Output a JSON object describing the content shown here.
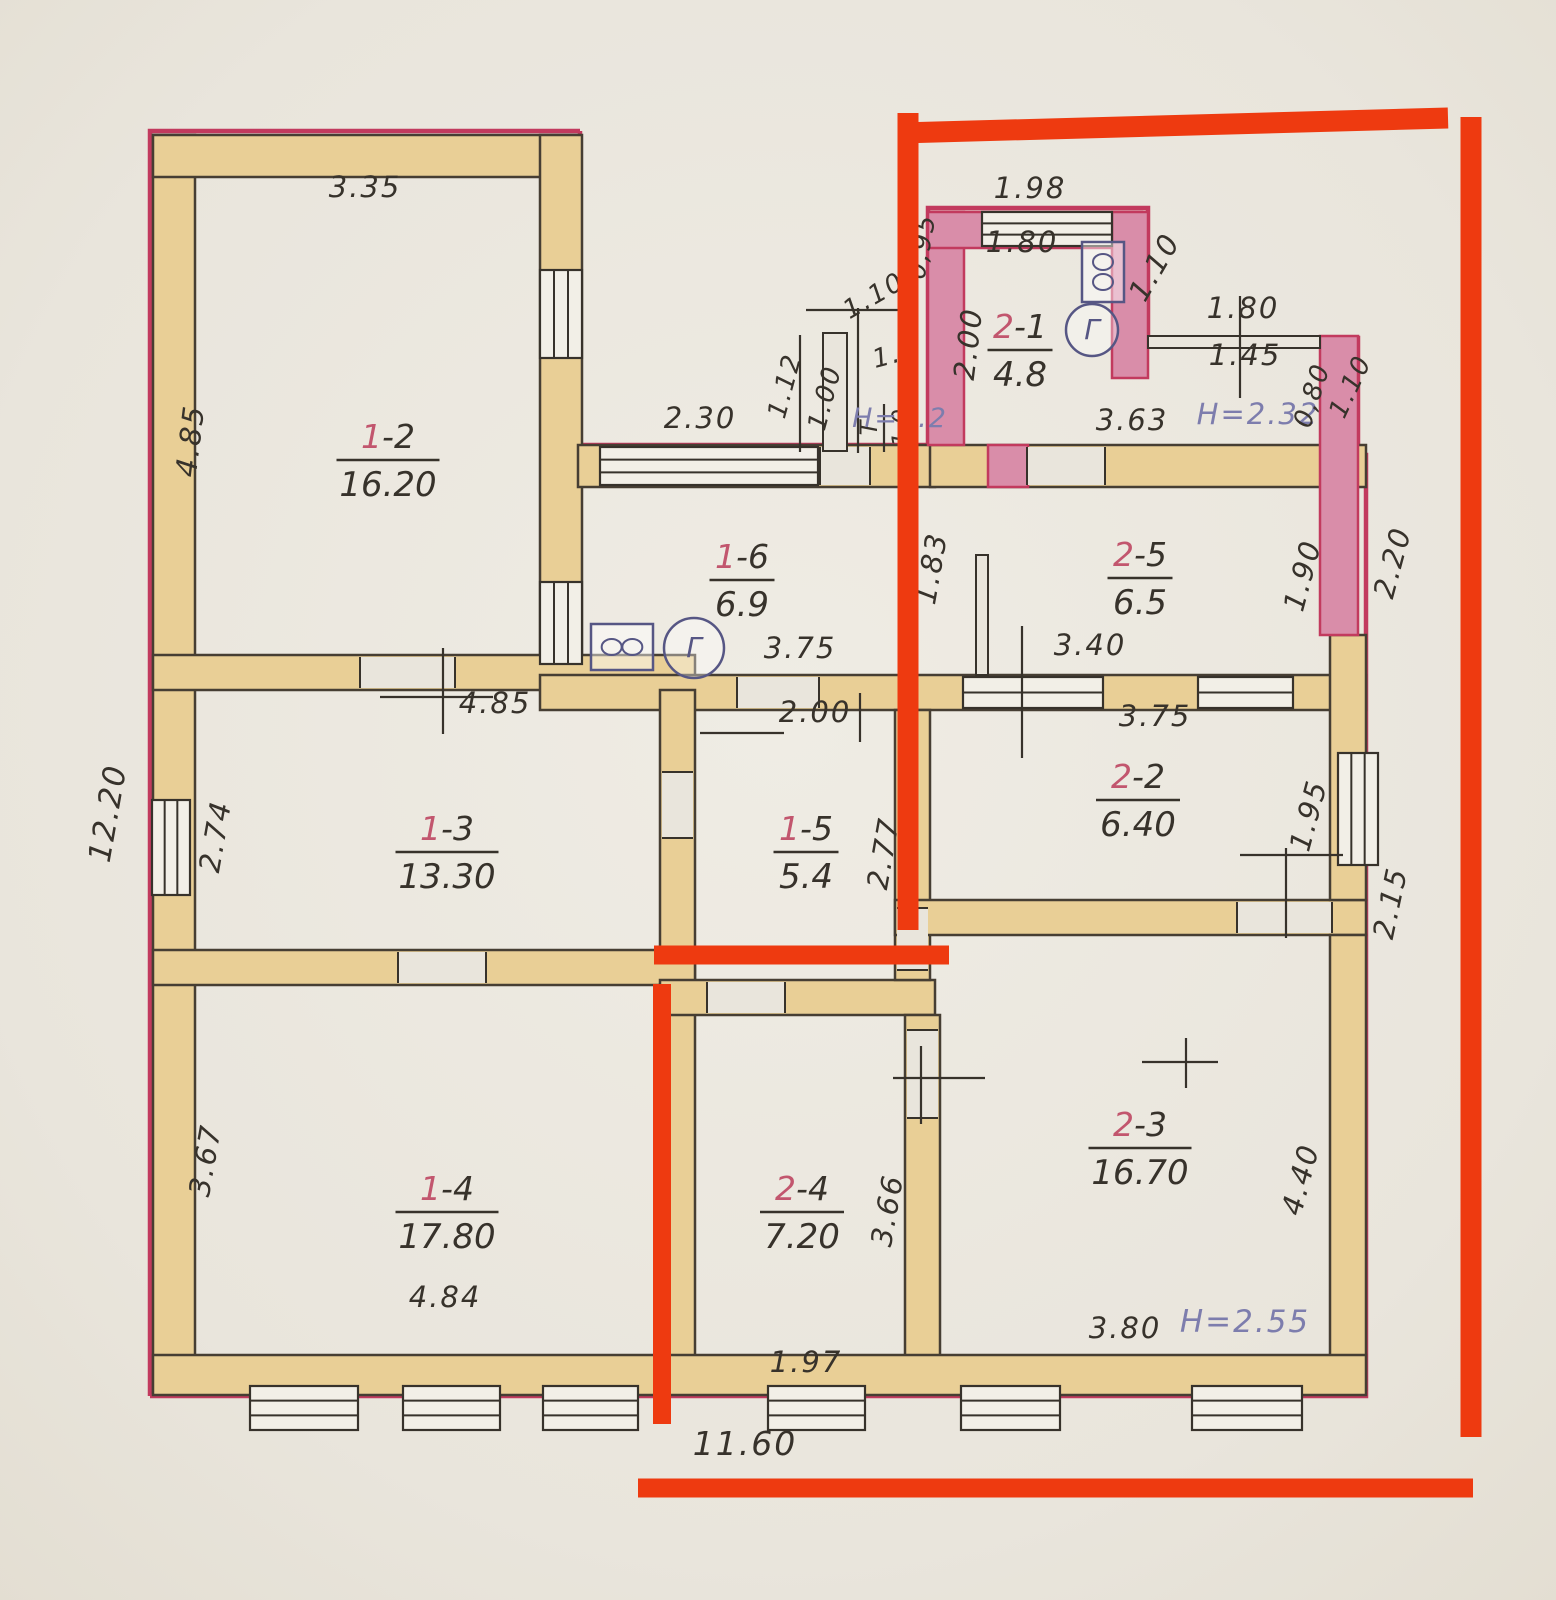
{
  "palette": {
    "paper": "#e9e5dc",
    "paper2": "#efece4",
    "ink": "#37322b",
    "wall": "#e9cf96",
    "wallStroke": "#463e33",
    "pink": "#d98da9",
    "crimson": "#c23a5e",
    "blue": "#7d7dad",
    "redNum": "#c2566e",
    "winFill": "#f2efe7",
    "icon": "#565684",
    "overlay": "#ee3a10"
  },
  "rooms": [
    {
      "p": "1",
      "s": "-2",
      "area": "16.20",
      "x": 388,
      "y": 460
    },
    {
      "p": "1",
      "s": "-3",
      "area": "13.30",
      "x": 447,
      "y": 852
    },
    {
      "p": "1",
      "s": "-4",
      "area": "17.80",
      "x": 447,
      "y": 1212
    },
    {
      "p": "1",
      "s": "-5",
      "area": "5.4",
      "x": 806,
      "y": 852
    },
    {
      "p": "1",
      "s": "-6",
      "area": "6.9",
      "x": 742,
      "y": 580
    },
    {
      "p": "2",
      "s": "-1",
      "area": "4.8",
      "x": 1020,
      "y": 350
    },
    {
      "p": "2",
      "s": "-2",
      "area": "6.40",
      "x": 1138,
      "y": 800
    },
    {
      "p": "2",
      "s": "-3",
      "area": "16.70",
      "x": 1140,
      "y": 1148
    },
    {
      "p": "2",
      "s": "-4",
      "area": "7.20",
      "x": 802,
      "y": 1212
    },
    {
      "p": "2",
      "s": "-5",
      "area": "6.5",
      "x": 1140,
      "y": 578
    }
  ],
  "vestibule": {
    "top": "Т",
    "area": "1.0",
    "x": 884,
    "y": 428
  },
  "dims": [
    {
      "t": "3.35",
      "x": 365,
      "y": 197
    },
    {
      "t": "4.85",
      "x": 200,
      "y": 442,
      "r": -83
    },
    {
      "t": "2.30",
      "x": 700,
      "y": 428
    },
    {
      "t": "4.85",
      "x": 495,
      "y": 713
    },
    {
      "t": "12.20",
      "x": 118,
      "y": 815,
      "r": -80,
      "s": 31
    },
    {
      "t": "2.74",
      "x": 225,
      "y": 838,
      "r": -80
    },
    {
      "t": "3.67",
      "x": 215,
      "y": 1162,
      "r": -80
    },
    {
      "t": "4.84",
      "x": 445,
      "y": 1307
    },
    {
      "t": "11.60",
      "x": 745,
      "y": 1455,
      "s": 33
    },
    {
      "t": "1.97",
      "x": 806,
      "y": 1372
    },
    {
      "t": "3.66",
      "x": 897,
      "y": 1212,
      "r": -80
    },
    {
      "t": "3.80",
      "x": 1125,
      "y": 1338
    },
    {
      "t": "H=2.55",
      "x": 1245,
      "y": 1332,
      "c": "blue",
      "s": 31
    },
    {
      "t": "4.40",
      "x": 1310,
      "y": 1182,
      "r": -75
    },
    {
      "t": "2.15",
      "x": 1400,
      "y": 905,
      "r": -78
    },
    {
      "t": "1.95",
      "x": 1318,
      "y": 818,
      "r": -75
    },
    {
      "t": "3.75",
      "x": 1155,
      "y": 726
    },
    {
      "t": "3.40",
      "x": 1090,
      "y": 655
    },
    {
      "t": "3.75",
      "x": 800,
      "y": 658
    },
    {
      "t": "2.00",
      "x": 815,
      "y": 722
    },
    {
      "t": "2.77",
      "x": 893,
      "y": 855,
      "r": -80
    },
    {
      "t": "1.83",
      "x": 941,
      "y": 570,
      "r": -80
    },
    {
      "t": "1.90",
      "x": 1312,
      "y": 578,
      "r": -75
    },
    {
      "t": "2.20",
      "x": 1402,
      "y": 565,
      "r": -75
    },
    {
      "t": "3.63",
      "x": 1132,
      "y": 430
    },
    {
      "t": "H=2.32",
      "x": 1258,
      "y": 424,
      "c": "blue"
    },
    {
      "t": "1.98",
      "x": 1030,
      "y": 198
    },
    {
      "t": "1.80",
      "x": 1022,
      "y": 252
    },
    {
      "t": "0,95",
      "x": 930,
      "y": 248,
      "r": -80,
      "s": 26
    },
    {
      "t": "2.00",
      "x": 978,
      "y": 345,
      "r": -83
    },
    {
      "t": "1.10",
      "x": 1163,
      "y": 272,
      "r": -60
    },
    {
      "t": "1.80",
      "x": 1243,
      "y": 318
    },
    {
      "t": "1.45",
      "x": 1245,
      "y": 365
    },
    {
      "t": "0,80",
      "x": 1320,
      "y": 398,
      "r": -72,
      "s": 26
    },
    {
      "t": "1.10",
      "x": 1358,
      "y": 390,
      "r": -65,
      "s": 26
    },
    {
      "t": "1.10",
      "x": 878,
      "y": 303,
      "r": -30,
      "s": 26
    },
    {
      "t": "1.12",
      "x": 793,
      "y": 388,
      "r": -75,
      "s": 26
    },
    {
      "t": "1.00",
      "x": 833,
      "y": 400,
      "r": -75,
      "s": 26
    },
    {
      "t": "1.6",
      "x": 898,
      "y": 362,
      "r": -15,
      "s": 26
    },
    {
      "t": "H=2.2",
      "x": 900,
      "y": 427,
      "c": "blue",
      "s": 27
    }
  ],
  "walls": {
    "tan": [
      [
        153,
        135,
        42,
        1258
      ],
      [
        153,
        135,
        427,
        42
      ],
      [
        540,
        135,
        42,
        555
      ],
      [
        578,
        445,
        357,
        42
      ],
      [
        930,
        445,
        436,
        42
      ],
      [
        153,
        655,
        542,
        35
      ],
      [
        540,
        675,
        826,
        35
      ],
      [
        660,
        690,
        35,
        300
      ],
      [
        153,
        950,
        542,
        35
      ],
      [
        660,
        985,
        35,
        405
      ],
      [
        660,
        980,
        275,
        35
      ],
      [
        895,
        710,
        35,
        270
      ],
      [
        895,
        900,
        471,
        35
      ],
      [
        905,
        1015,
        35,
        375
      ],
      [
        1330,
        635,
        36,
        265
      ],
      [
        1330,
        935,
        36,
        455
      ],
      [
        153,
        1355,
        1213,
        40
      ]
    ],
    "pink": [
      [
        928,
        212,
        36,
        233
      ],
      [
        928,
        212,
        214,
        36
      ],
      [
        1112,
        212,
        36,
        166
      ],
      [
        1320,
        336,
        38,
        299
      ],
      [
        988,
        445,
        40,
        42
      ]
    ],
    "thin": [
      [
        1148,
        336,
        172,
        12
      ],
      [
        976,
        555,
        12,
        120
      ]
    ]
  },
  "cuts": [
    [
      360,
      657,
      95,
      31
    ],
    [
      398,
      952,
      88,
      31
    ],
    [
      737,
      677,
      82,
      31
    ],
    [
      662,
      772,
      31,
      66
    ],
    [
      1027,
      447,
      78,
      38
    ],
    [
      897,
      908,
      31,
      62
    ],
    [
      1237,
      902,
      95,
      31
    ],
    [
      907,
      1030,
      31,
      88
    ],
    [
      707,
      982,
      78,
      31
    ],
    [
      820,
      447,
      50,
      38
    ]
  ],
  "windows": [
    [
      152,
      800,
      38,
      95,
      2
    ],
    [
      540,
      270,
      42,
      88,
      2
    ],
    [
      540,
      582,
      42,
      82,
      2
    ],
    [
      600,
      447,
      218,
      38,
      2
    ],
    [
      982,
      212,
      130,
      34,
      2
    ],
    [
      963,
      677,
      140,
      31,
      1
    ],
    [
      1198,
      677,
      95,
      31,
      1
    ],
    [
      1338,
      753,
      40,
      112,
      2
    ],
    [
      250,
      1386,
      108,
      44,
      2
    ],
    [
      403,
      1386,
      97,
      44,
      2
    ],
    [
      543,
      1386,
      95,
      44,
      2
    ],
    [
      768,
      1386,
      97,
      44,
      2
    ],
    [
      961,
      1386,
      99,
      44,
      2
    ],
    [
      1192,
      1386,
      110,
      44,
      2
    ]
  ],
  "ticks": [
    [
      443,
      648,
      443,
      734
    ],
    [
      380,
      697,
      493,
      697
    ],
    [
      1022,
      626,
      1022,
      758
    ],
    [
      921,
      1046,
      921,
      1124
    ],
    [
      893,
      1078,
      985,
      1078
    ],
    [
      1142,
      1062,
      1218,
      1062
    ],
    [
      1186,
      1038,
      1186,
      1088
    ],
    [
      860,
      693,
      860,
      742
    ],
    [
      1286,
      848,
      1286,
      938
    ],
    [
      1240,
      855,
      1343,
      855
    ],
    [
      858,
      308,
      858,
      453
    ],
    [
      806,
      310,
      902,
      310
    ],
    [
      800,
      335,
      800,
      452
    ],
    [
      1240,
      296,
      1240,
      398
    ],
    [
      700,
      733,
      784,
      733
    ]
  ],
  "porch": {
    "rect": [
      823,
      333,
      24,
      118
    ]
  },
  "icons": {
    "glyph": "Г",
    "meters": [
      {
        "cx": 694,
        "cy": 648,
        "r": 30
      },
      {
        "cx": 1092,
        "cy": 330,
        "r": 26
      }
    ],
    "stoves": [
      {
        "x": 591,
        "y": 624,
        "w": 62,
        "h": 46
      },
      {
        "x": 1082,
        "y": 242,
        "w": 42,
        "h": 60
      }
    ]
  },
  "outline": [
    [
      [
        150,
        1396
      ],
      [
        150,
        131
      ],
      [
        580,
        131
      ]
    ],
    [
      [
        580,
        131
      ],
      [
        580,
        445
      ],
      [
        928,
        445
      ],
      [
        928,
        208
      ],
      [
        1148,
        208
      ],
      [
        1148,
        336
      ]
    ],
    [
      [
        1322,
        338
      ],
      [
        1358,
        338
      ],
      [
        1358,
        455
      ],
      [
        1366,
        455
      ],
      [
        1366,
        1396
      ],
      [
        150,
        1396
      ]
    ]
  ],
  "overlay": {
    "lines": [
      [
        900,
        133,
        1448,
        118,
        21
      ],
      [
        1471,
        117,
        1471,
        1437,
        21
      ],
      [
        908,
        113,
        908,
        930,
        21
      ],
      [
        654,
        955,
        949,
        955,
        19
      ],
      [
        662,
        984,
        662,
        1424,
        18
      ],
      [
        638,
        1488,
        1473,
        1488,
        19
      ]
    ]
  }
}
